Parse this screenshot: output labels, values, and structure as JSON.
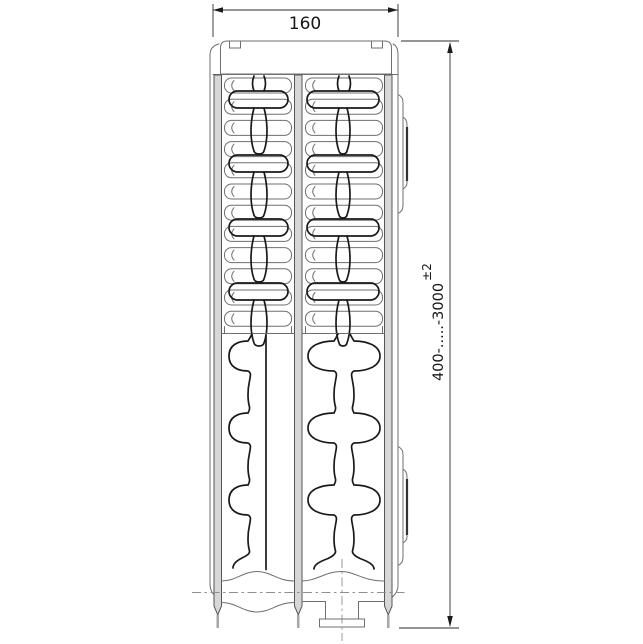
{
  "dimensions": {
    "width": {
      "value": "160"
    },
    "height": {
      "value": "400-.....-3000",
      "tolerance": "±2"
    }
  },
  "colors": {
    "background": "#ffffff",
    "outline": "#6f6f6f",
    "channel_line": "#1a1a1a",
    "panel_fill": "#d7d7d7",
    "dimension_line": "#2b2b2b",
    "centerline": "#8f8f8f"
  }
}
